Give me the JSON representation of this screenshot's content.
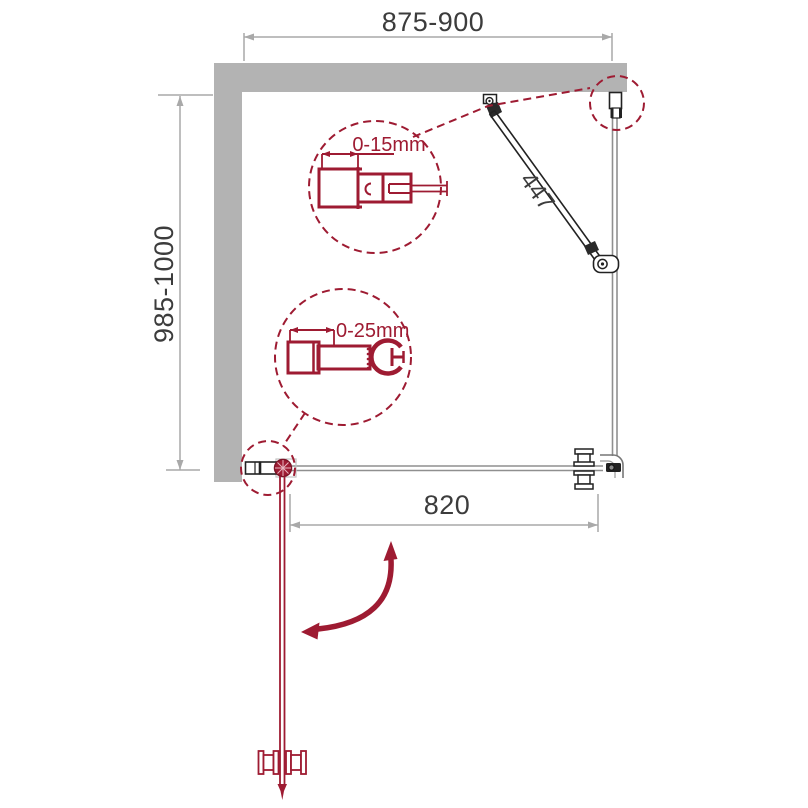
{
  "drawing": {
    "type": "shower-enclosure-plan-technical-drawing",
    "dimensions": {
      "top_width": {
        "label": "875-900"
      },
      "left_depth": {
        "label": "985-1000"
      },
      "support_bar_length": {
        "label": "447"
      },
      "door_glass_width": {
        "label": "820"
      }
    },
    "callouts": {
      "wall_profile_adjustment": {
        "label": "0-15mm"
      },
      "pivot_profile_adjustment": {
        "label": "0-25mm"
      }
    },
    "colors": {
      "background": "#ffffff",
      "wall_fill": "#b3b3b3",
      "hardware_line": "#222222",
      "glass_line": "#8f8f8f",
      "dimension_line": "#a9a9a9",
      "dimension_text": "#3c3c3c",
      "accent_red": "#9e1b32"
    }
  }
}
